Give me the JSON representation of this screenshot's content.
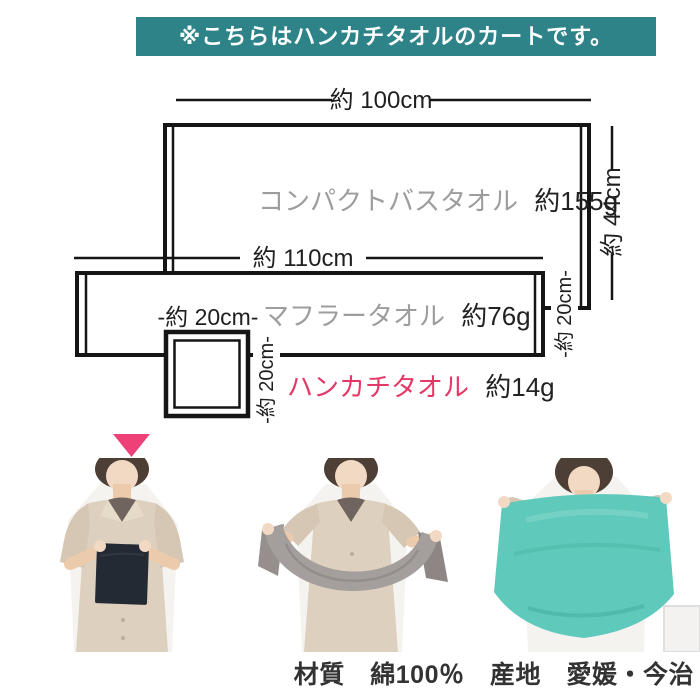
{
  "banner": {
    "text": "※こちらはハンカチタオルのカートです。",
    "bg_color": "#2e8389",
    "text_color": "#ffffff"
  },
  "diagram": {
    "towels": [
      {
        "name": "コンパクトバスタオル",
        "weight": "約155g",
        "width": "約 100cm",
        "height": "約 44cm"
      },
      {
        "name": "マフラータオル",
        "weight": "約76g",
        "width": "約 110cm",
        "height": "-約 20cm-"
      },
      {
        "name": "ハンカチタオル",
        "weight": "約14g",
        "width": "-約 20cm-",
        "height": "-約 20cm-"
      }
    ],
    "accent_pink": "#e63866",
    "line_color": "#151515",
    "muted_label_color": "#9d9d9d"
  },
  "photos": [
    {
      "name": "model-holding-handkerchief-towel",
      "towel_color": "#232a33"
    },
    {
      "name": "model-holding-muffler-towel",
      "towel_color": "#a49e9c"
    },
    {
      "name": "model-holding-compact-bath-towel",
      "towel_color": "#5fc9bb"
    }
  ],
  "footer": {
    "text": "材質　綿100％　産地　愛媛・今治"
  }
}
